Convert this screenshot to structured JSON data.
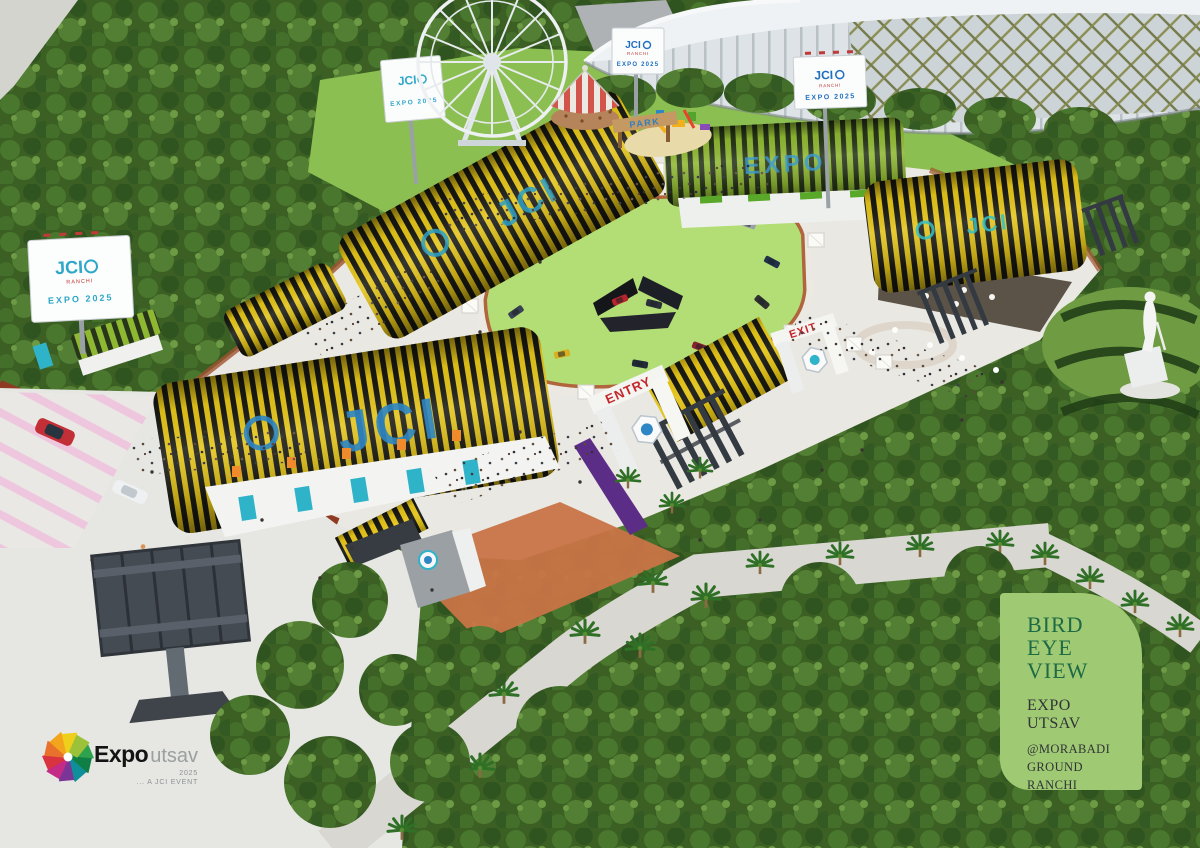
{
  "labels": {
    "jci": "JCI",
    "expo": "EXPO",
    "expo2025": "EXPO 2025",
    "ranchi": "RANCHI",
    "entry": "ENTRY",
    "exit": "EXIT",
    "park": "PARK"
  },
  "info_card": {
    "title_l1": "BIRD",
    "title_l2": "EYE",
    "title_l3": "VIEW",
    "event": "EXPO UTSAV",
    "venue_l1": "@MORABADI",
    "venue_l2": "GROUND",
    "venue_l3": "RANCHI",
    "bg_color": "#a0c973",
    "title_color": "#1d6a45",
    "text_color": "#2f3437"
  },
  "event_logo": {
    "brand_bold": "Expo",
    "brand_light": "utsav",
    "year": "2025",
    "tagline": "... A JCI EVENT"
  },
  "colors": {
    "roof_stripe_yellow": "#e4c418",
    "roof_stripe_black": "#191914",
    "roof_stripe_green": "#8fb832",
    "jci_teal": "#2fb3c9",
    "jci_blue": "#2e86c4",
    "gate_text_red": "#c4262c",
    "lawn_green": "#b3de76",
    "tree_green": "#3c6023",
    "terracotta": "#c97447",
    "parking_pink": "#eec7de",
    "purple_wall": "#5c2d86"
  }
}
